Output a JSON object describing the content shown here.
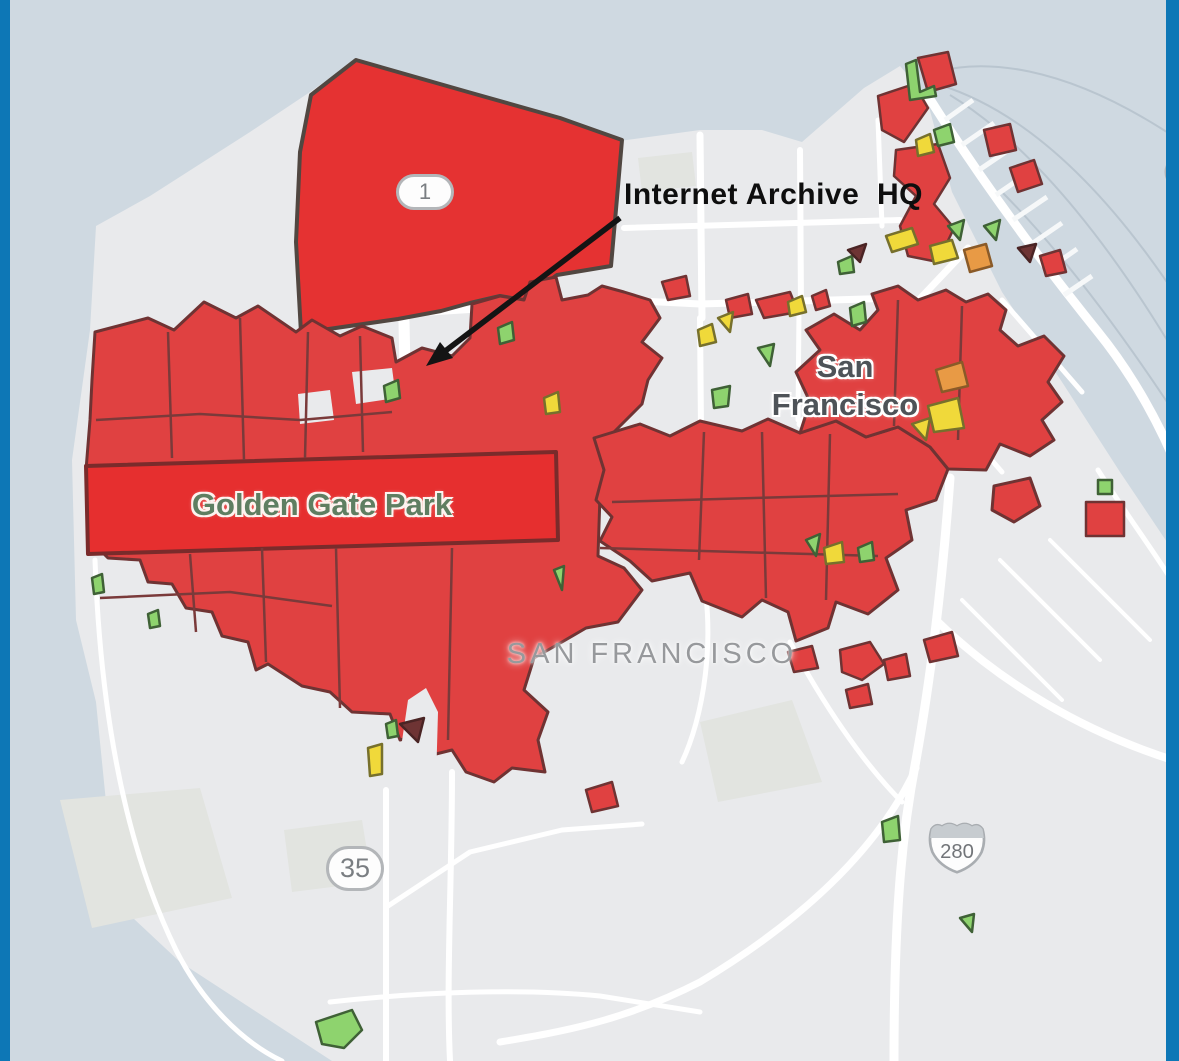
{
  "window": {
    "width": 1179,
    "height": 1061
  },
  "frame": {
    "border_color": "#0d77b6"
  },
  "labels": {
    "annotation": "Internet Archive  HQ",
    "city": "San\nFrancisco",
    "county": "SAN FRANCISCO",
    "park": "Golden Gate Park"
  },
  "shields": {
    "route1": "1",
    "route35": "35",
    "route280": "280"
  },
  "colors": {
    "water": "#cfd9e1",
    "ferry": "#b9c5cf",
    "land": "#e9eaec",
    "land_patch": "#e2e4e0",
    "road": "#ffffff",
    "pier": "#f6f8f9",
    "arrow": "#141414",
    "inner_border": "#7a3a3a",
    "zones": {
      "red": {
        "fill": "#e04141",
        "stroke": "#6f3333"
      },
      "red_bright": {
        "fill": "#e62f2f",
        "stroke": "#7a2b2b"
      },
      "presidio": {
        "fill": "#e53232",
        "stroke": "#514741"
      },
      "orange": {
        "fill": "#e89a45",
        "stroke": "#8a5a28"
      },
      "yellow": {
        "fill": "#f0d93a",
        "stroke": "#77702c"
      },
      "green": {
        "fill": "#8ed36e",
        "stroke": "#3f6136"
      },
      "dark": {
        "fill": "#6e3434",
        "stroke": "#4a2424"
      },
      "land": {
        "fill": "#e9eaec",
        "stroke": "#e9eaec"
      }
    }
  },
  "map": {
    "water_polys": [
      {
        "name": "ocean-and-bay",
        "points": "0,0 1179,0 1179,560 1120,472 1062,382 1002,292 952,192 926,96 900,66 864,88 802,142 762,130 700,130 612,142 430,96 358,58 310,92 250,132 150,196 96,226 90,330 72,460 76,620 96,702 116,902 180,962 332,1061 0,1061"
      }
    ],
    "ferry_routes": [
      "M1179,140 C1060,60 980,60 935,72",
      "M1179,300 C1100,180 1020,110 940,85",
      "M1179,420 C1120,330 1060,250 1000,190",
      "M950,95 C1040,150 1120,260 1179,360"
    ],
    "piers": [
      "M945,120 L973,100",
      "M962,145 L994,123",
      "M979,170 L1013,147",
      "M996,195 L1034,169",
      "M1013,220 L1047,197",
      "M1030,245 L1062,223",
      "M1047,270 L1077,249",
      "M1064,295 L1092,276"
    ],
    "land_patches": [
      {
        "points": "60,800 200,788 232,898 92,928"
      },
      {
        "points": "700,722 792,700 822,782 718,802"
      },
      {
        "points": "284,830 362,820 372,882 292,892"
      },
      {
        "points": "638,158 692,152 696,186 642,192"
      }
    ],
    "roads": [
      {
        "name": "marina-v1",
        "d": "M700,135 L702,318",
        "w": 7
      },
      {
        "name": "marina-v2",
        "d": "M800,150 L801,310",
        "w": 6
      },
      {
        "name": "marina-v3",
        "d": "M878,120 L882,226",
        "w": 5
      },
      {
        "name": "pacific-h",
        "d": "M624,228 L900,220",
        "w": 6
      },
      {
        "name": "california-h",
        "d": "M430,312 L620,300 L700,304 L898,298",
        "w": 7
      },
      {
        "name": "park-presidio",
        "d": "M404,322 L407,462",
        "w": 11
      },
      {
        "name": "center-v1",
        "d": "M700,318 L701,430",
        "w": 6
      },
      {
        "name": "center-v2",
        "d": "M799,310 L798,420",
        "w": 5
      },
      {
        "name": "market-st",
        "d": "M968,248 L898,322 L830,392 L800,424",
        "w": 7
      },
      {
        "name": "soma-d1",
        "d": "M1002,300 L1082,392",
        "w": 5
      },
      {
        "name": "soma-d2",
        "d": "M962,340 L1042,432",
        "w": 5
      },
      {
        "name": "soma-d3",
        "d": "M922,380 L1002,472",
        "w": 5
      },
      {
        "name": "embarcadero",
        "d": "M928,96 C982,182 1040,260 1098,332 C1132,374 1160,424 1179,472",
        "w": 9
      },
      {
        "name": "embarcadero-s",
        "d": "M1098,470 C1130,520 1160,560 1179,592",
        "w": 5
      },
      {
        "name": "center-v3",
        "d": "M700,432 L701,560",
        "w": 5
      },
      {
        "name": "valencia-s",
        "d": "M700,560 C718,640 702,720 682,762",
        "w": 5
      },
      {
        "name": "bayshore",
        "d": "M790,642 C822,702 862,762 902,802",
        "w": 5
      },
      {
        "name": "freeway-101",
        "d": "M950,478 C944,560 934,660 916,760 C904,822 894,900 894,1061",
        "w": 9
      },
      {
        "name": "freeway-280e",
        "d": "M938,622 C1000,682 1082,732 1179,762",
        "w": 8
      },
      {
        "name": "freeway-sw",
        "d": "M916,768 C878,850 800,922 700,982 C622,1022 560,1032 500,1042",
        "w": 7
      },
      {
        "name": "nineteenth-s",
        "d": "M452,772 C452,880 446,980 450,1061",
        "w": 6
      },
      {
        "name": "hwy35-v",
        "d": "M386,790 L386,1061",
        "w": 6
      },
      {
        "name": "hwy35-d",
        "d": "M388,906 L470,852 L562,830 L642,824",
        "w": 5
      },
      {
        "name": "bottom-h",
        "d": "M330,1002 C420,992 520,988 600,996 L700,1012",
        "w": 5
      },
      {
        "name": "great-hwy",
        "d": "M95,560 C100,700 122,840 176,950 C202,1002 242,1042 282,1061",
        "w": 5
      },
      {
        "name": "br-d1",
        "d": "M1000,560 L1100,660",
        "w": 4
      },
      {
        "name": "br-d2",
        "d": "M1050,540 L1150,640",
        "w": 4
      },
      {
        "name": "br-d3",
        "d": "M962,600 L1062,700",
        "w": 4
      }
    ],
    "zones_major": [
      {
        "cat": "presidio",
        "sw": 4,
        "name": "presidio",
        "points": "356,60 468,92 560,118 622,140 617,198 611,266 557,275 523,300 500,296 470,303 441,311 398,319 301,333 296,242 300,152 311,95"
      },
      {
        "cat": "red",
        "sw": 3,
        "name": "richmond-sunset",
        "points": "95,332 148,318 174,330 204,302 236,318 258,306 296,332 312,320 340,336 362,326 392,338 396,362 422,348 452,356 470,338 472,304 500,296 524,300 530,282 556,277 562,300 588,295 602,286 624,292 650,300 660,318 642,342 662,358 648,380 642,404 614,432 648,462 652,492 600,495 598,556 624,568 642,590 618,622 586,628 562,642 534,658 524,690 548,712 538,740 545,772 512,768 494,782 466,772 452,750 436,754 428,732 400,740 390,714 352,712 330,692 302,686 268,664 256,670 248,642 222,636 212,612 186,608 172,584 148,582 140,560 108,558 96,546 88,522 86,470 90,420 92,380"
      },
      {
        "cat": "red",
        "sw": 3,
        "name": "central-east",
        "points": "594,438 640,424 670,436 700,421 742,431 768,419 800,433 836,421 866,437 898,427 930,447 948,469 936,500 906,510 912,540 886,558 898,590 868,614 836,602 828,628 796,641 788,612 762,600 742,617 702,601 690,573 652,581 630,561 600,541 612,517 596,500 604,470"
      },
      {
        "cat": "red",
        "sw": 3,
        "name": "downtown",
        "points": "800,433 810,402 796,372 820,350 806,330 834,314 860,330 878,310 872,294 898,286 918,300 946,290 966,302 988,294 1006,310 1000,330 1018,346 1044,336 1064,356 1048,382 1062,402 1042,420 1054,440 1030,456 1000,444 986,470 948,469 930,447 898,427 866,437 836,421"
      },
      {
        "cat": "red",
        "sw": 3,
        "name": "soma-satellite",
        "points": "994,486 1030,478 1040,506 1014,522 992,510"
      },
      {
        "cat": "red_bright",
        "sw": 4,
        "name": "golden-gate-park",
        "points": "86,466 556,452 558,540 88,554"
      }
    ],
    "notches": [
      {
        "points": "396,782 408,700 426,688 438,712 436,782"
      },
      {
        "points": "352,372 392,368 396,398 356,404"
      },
      {
        "points": "298,394 330,390 334,420 300,424"
      }
    ],
    "inner_borders": [
      "M168,332 L172,458",
      "M240,318 L244,460",
      "M308,332 L305,458",
      "M360,336 L363,452",
      "M96,420 L200,414 L300,420 L392,412",
      "M190,554 L196,632",
      "M262,548 L266,662",
      "M336,548 L340,708",
      "M100,598 L230,592 L332,606",
      "M452,548 L448,740",
      "M704,432 L699,560",
      "M762,432 L766,598",
      "M830,434 L826,600",
      "M612,502 L898,494",
      "M600,548 L878,556",
      "M898,300 L894,426",
      "M962,306 L958,440"
    ],
    "zones_minor": [
      {
        "cat": "red",
        "points": "878,96 914,84 928,108 904,142 882,130"
      },
      {
        "cat": "red",
        "points": "918,58 948,52 956,84 928,92"
      },
      {
        "cat": "green",
        "points": "906,64 916,60 920,92 934,86 936,96 910,100"
      },
      {
        "cat": "red",
        "points": "896,150 938,144 950,178 934,204 954,228 938,262 908,256 900,226 916,196 894,176"
      },
      {
        "cat": "yellow",
        "points": "916,140 930,134 934,152 918,156"
      },
      {
        "cat": "green",
        "points": "934,130 950,124 954,142 938,146"
      },
      {
        "cat": "yellow",
        "points": "886,236 912,228 918,244 892,252"
      },
      {
        "cat": "yellow",
        "points": "930,246 952,240 958,258 934,264"
      },
      {
        "cat": "green",
        "points": "948,226 964,220 960,240"
      },
      {
        "cat": "green",
        "points": "984,226 1000,220 996,240"
      },
      {
        "cat": "orange",
        "points": "964,250 986,244 992,266 970,272"
      },
      {
        "cat": "red",
        "points": "984,130 1010,124 1016,150 990,156"
      },
      {
        "cat": "dark",
        "points": "1018,248 1036,244 1030,262"
      },
      {
        "cat": "red",
        "points": "1040,256 1060,250 1066,272 1046,276"
      },
      {
        "cat": "red",
        "points": "1010,168 1034,160 1042,184 1018,192"
      },
      {
        "cat": "red",
        "points": "662,282 686,276 690,296 668,300"
      },
      {
        "cat": "yellow",
        "points": "698,330 712,324 716,342 700,346"
      },
      {
        "cat": "red",
        "points": "726,300 748,294 752,314 730,318"
      },
      {
        "cat": "yellow",
        "points": "718,318 733,312 730,332"
      },
      {
        "cat": "red",
        "points": "756,300 790,292 798,312 764,318"
      },
      {
        "cat": "red",
        "points": "812,296 826,290 830,306 816,310"
      },
      {
        "cat": "green",
        "points": "850,308 864,302 866,322 852,326"
      },
      {
        "cat": "green",
        "points": "838,262 852,256 854,272 840,274"
      },
      {
        "cat": "dark",
        "points": "848,250 866,244 860,262"
      },
      {
        "cat": "yellow",
        "points": "788,302 802,296 806,312 790,316"
      },
      {
        "cat": "green",
        "points": "384,386 398,380 400,398 386,402"
      },
      {
        "cat": "green",
        "points": "498,328 512,322 514,340 500,344"
      },
      {
        "cat": "yellow",
        "points": "544,398 558,392 560,412 546,414"
      },
      {
        "cat": "green",
        "points": "712,390 730,386 728,406 714,408"
      },
      {
        "cat": "green",
        "points": "758,348 774,344 770,366"
      },
      {
        "cat": "yellow",
        "points": "928,406 958,398 964,428 934,432"
      },
      {
        "cat": "yellow",
        "points": "912,424 930,418 926,440"
      },
      {
        "cat": "orange",
        "points": "936,370 962,362 968,386 942,392"
      },
      {
        "cat": "green",
        "points": "806,540 820,534 816,556"
      },
      {
        "cat": "yellow",
        "points": "824,548 842,542 844,562 826,564"
      },
      {
        "cat": "green",
        "points": "858,548 872,542 874,560 860,562"
      },
      {
        "cat": "red",
        "points": "846,690 868,684 872,704 850,708"
      },
      {
        "cat": "red",
        "points": "884,660 906,654 910,676 888,680"
      },
      {
        "cat": "red",
        "points": "924,640 952,632 958,656 930,662"
      },
      {
        "cat": "red",
        "points": "586,790 612,782 618,806 592,812"
      },
      {
        "cat": "red",
        "points": "788,652 812,646 818,668 794,672"
      },
      {
        "cat": "red",
        "points": "840,650 870,642 884,664 862,680 842,672"
      },
      {
        "cat": "yellow",
        "points": "368,748 382,744 382,774 370,776"
      },
      {
        "cat": "green",
        "points": "386,724 396,720 398,736 388,738"
      },
      {
        "cat": "dark",
        "points": "400,724 424,718 418,742"
      },
      {
        "cat": "green",
        "points": "554,570 564,566 562,590"
      },
      {
        "cat": "green",
        "points": "92,578 102,574 104,592 94,594"
      },
      {
        "cat": "green",
        "points": "148,614 158,610 160,626 150,628"
      },
      {
        "cat": "green",
        "points": "882,822 898,816 900,840 884,842"
      },
      {
        "cat": "green",
        "points": "960,918 974,914 972,932"
      },
      {
        "cat": "green",
        "points": "316,1022 352,1010 362,1030 344,1048 322,1044"
      },
      {
        "cat": "green",
        "points": "1098,480 1112,480 1112,494 1098,494"
      },
      {
        "cat": "red",
        "points": "1086,502 1124,502 1124,536 1086,536"
      }
    ],
    "arrow": {
      "x1": 620,
      "y1": 218,
      "x2": 444,
      "y2": 352,
      "head": "426,366 440,342 453,358"
    },
    "partial_shield": {
      "cx": 1181,
      "cy": 172,
      "r": 15
    }
  },
  "positions": {
    "annotation": {
      "left": 624,
      "top": 178
    },
    "city": {
      "left": 845,
      "top": 348
    },
    "county": {
      "left": 652,
      "top": 638
    },
    "park": {
      "left": 322,
      "top": 487
    },
    "shield1": {
      "left": 396,
      "top": 174
    },
    "shield35": {
      "left": 326,
      "top": 846
    },
    "shield280": {
      "left": 924,
      "top": 816
    }
  }
}
